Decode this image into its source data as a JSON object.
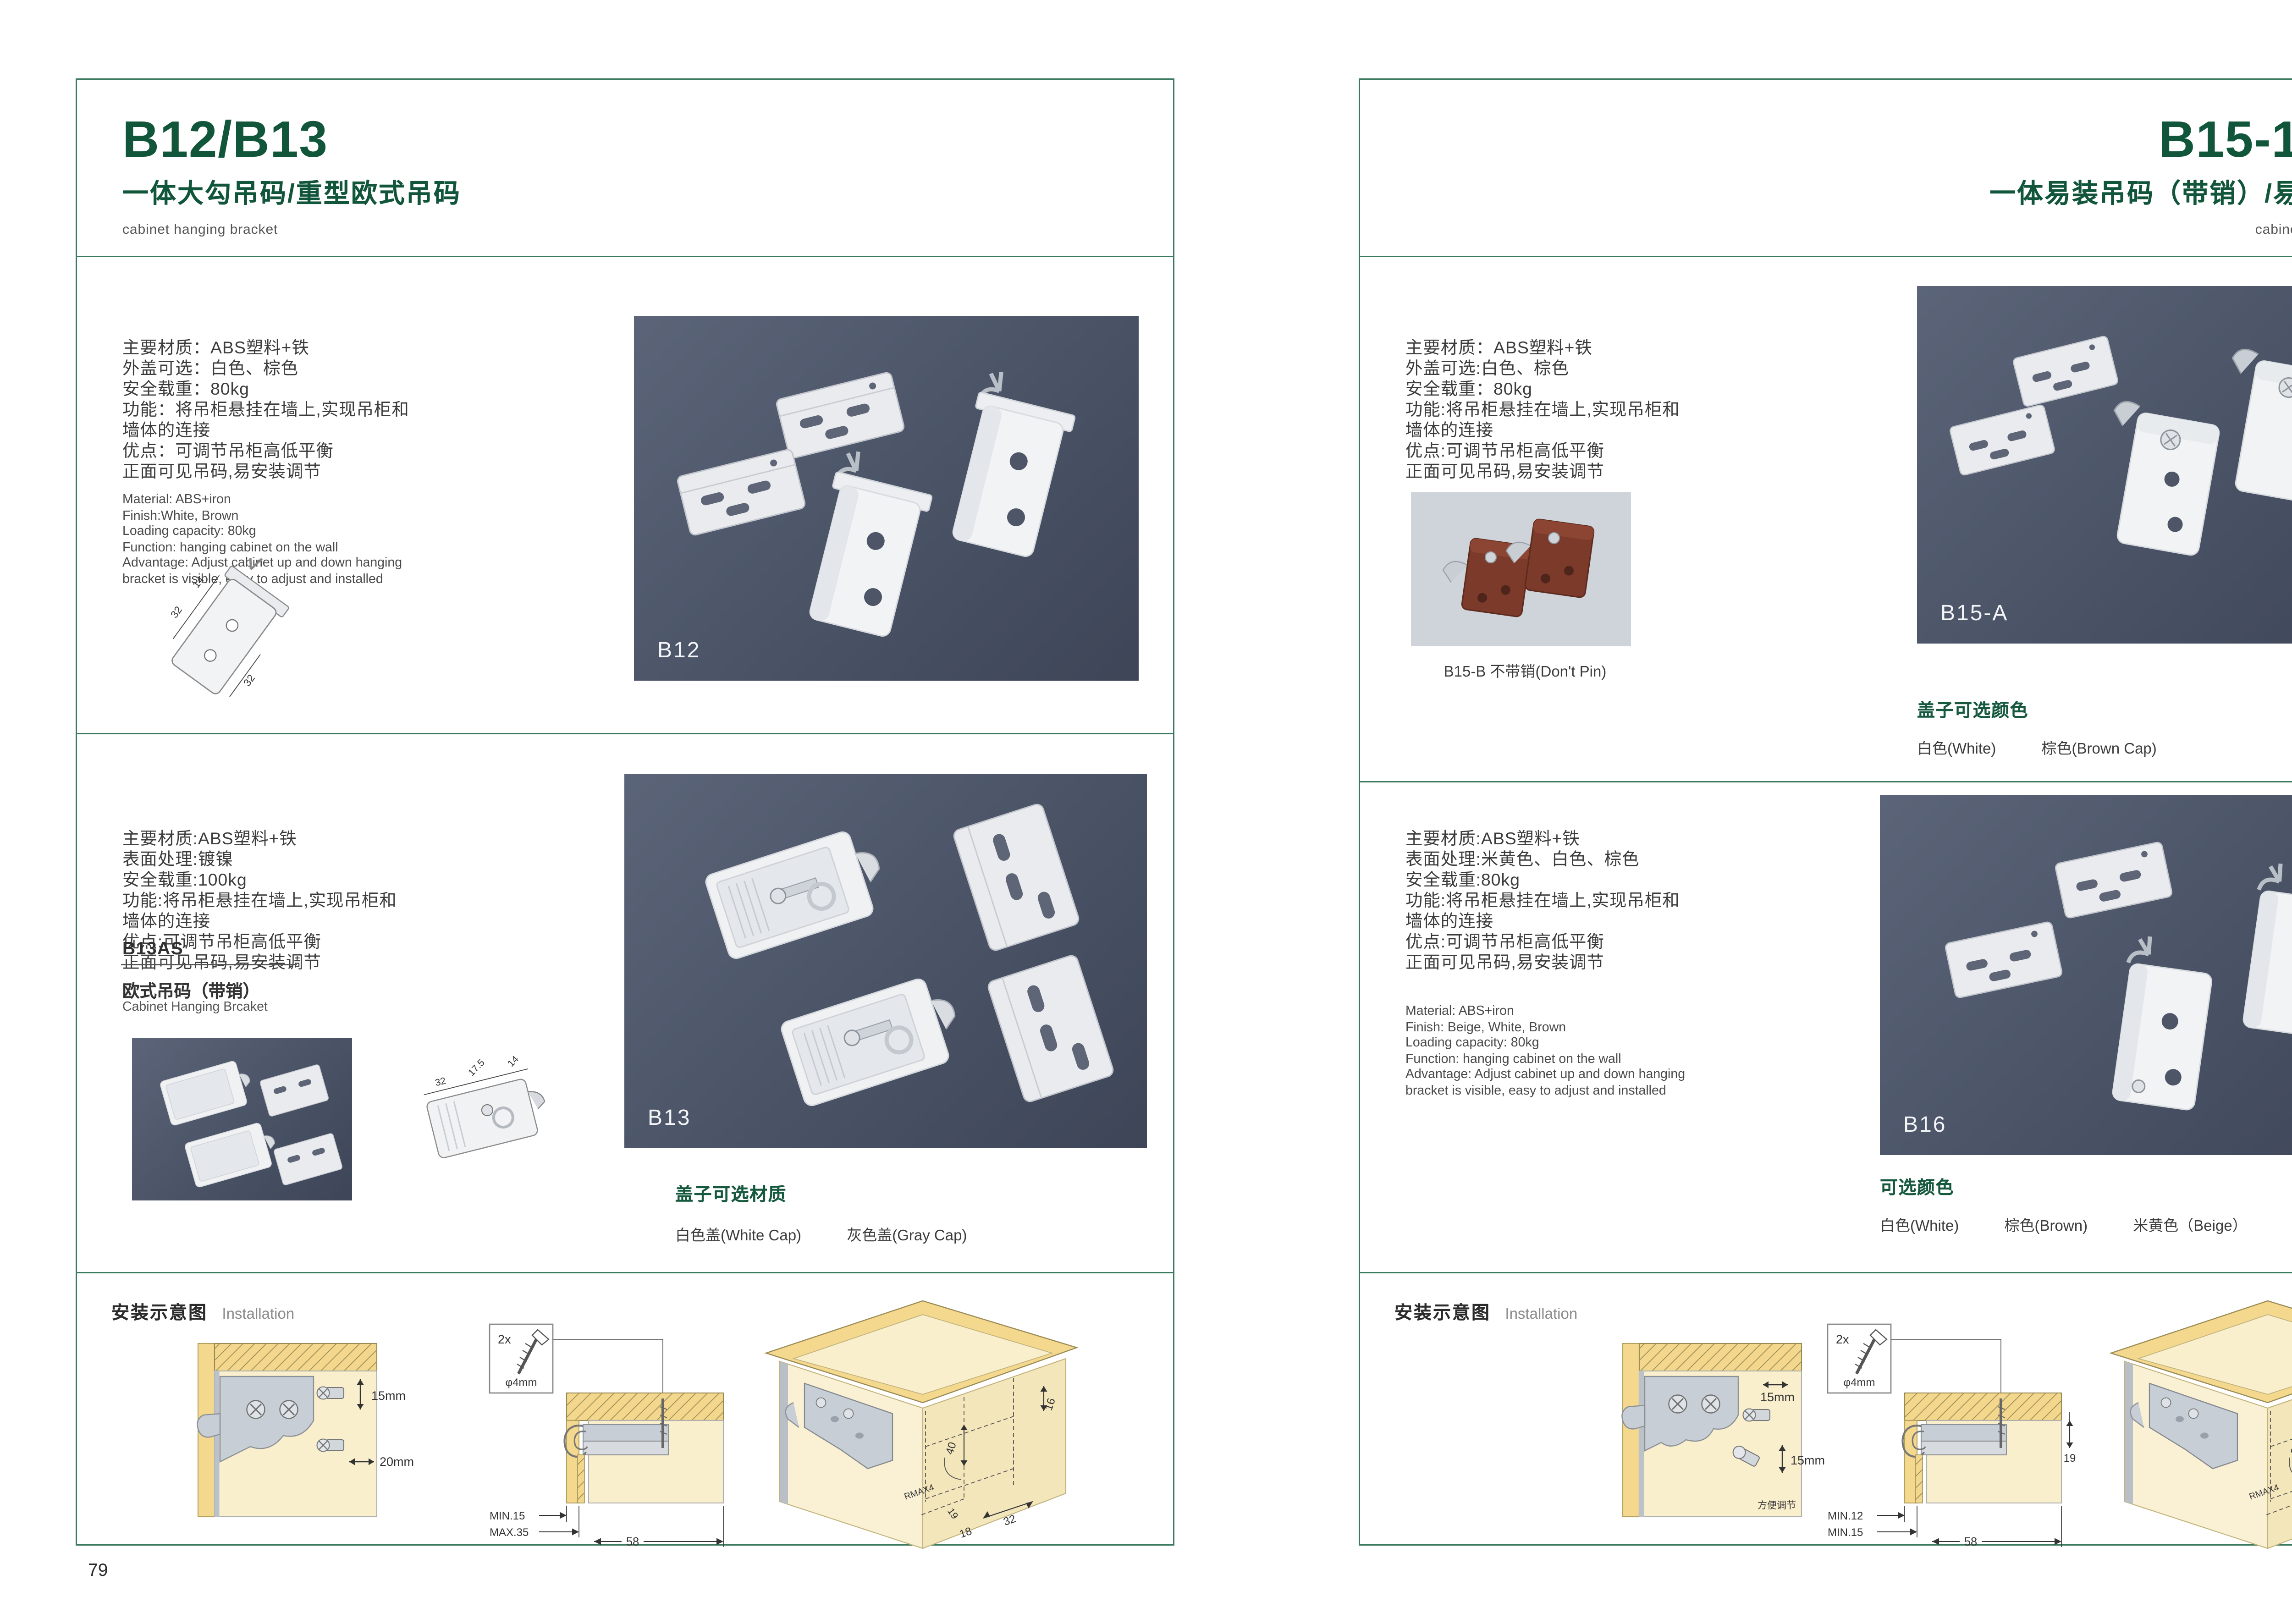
{
  "colors": {
    "accent_green": "#11563a",
    "border_green": "#3c7a60",
    "photo_background": "#4a5366",
    "wood_yellow": "#f3d88e",
    "wood_cream": "#f9efcd",
    "bracket_gray": "#c8ced5"
  },
  "left_page": {
    "page_number": "79",
    "header": {
      "title": "B12/B13",
      "subtitle": "一体大勾吊码/重型欧式吊码",
      "category": "cabinet hanging bracket"
    },
    "b12": {
      "specs_cn": [
        "主要材质：ABS塑料+铁",
        "外盖可选：白色、棕色",
        "安全载重：80kg",
        "功能：将吊柜悬挂在墙上,实现吊柜和",
        "墙体的连接",
        "优点：可调节吊柜高低平衡",
        "正面可见吊码,易安装调节"
      ],
      "specs_en": [
        "Material: ABS+iron",
        "Finish:White, Brown",
        "Loading capacity: 80kg",
        "Function: hanging cabinet on the wall",
        "Advantage: Adjust cabinet up and down hanging",
        "bracket is visible, easy to adjust and installed"
      ],
      "dims": {
        "a": "14",
        "b": "32",
        "c": "32"
      },
      "photo_label": "B12"
    },
    "b13": {
      "specs_cn": [
        "主要材质:ABS塑料+铁",
        "表面处理:镀镍",
        "安全载重:100kg",
        "功能:将吊柜悬挂在墙上,实现吊柜和",
        "墙体的连接",
        "优点:可调节吊柜高低平衡",
        "正面可见吊码,易安装调节"
      ],
      "model_code": "B13AS",
      "model_cn": "欧式吊码（带销）",
      "model_en": "Cabinet Hanging Brcaket",
      "dims": {
        "a": "32",
        "b": "17.5",
        "c": "14"
      },
      "photo_label": "B13",
      "options_title": "盖子可选材质",
      "options": [
        "白色盖(White Cap)",
        "灰色盖(Gray Cap)"
      ]
    },
    "install": {
      "title_cn": "安装示意图",
      "title_en": "Installation",
      "dim_v": "15mm",
      "dim_h": "20mm",
      "screw_qty": "2x",
      "screw_dia": "φ4mm",
      "min": "MIN.15",
      "max": "MAX.35",
      "span": "58",
      "d1": "16",
      "d2": "40",
      "d3": "RMAX4",
      "d4": "19",
      "d5": "18",
      "d6": "32"
    }
  },
  "right_page": {
    "page_number": "80",
    "header": {
      "title": "B15-1/B16",
      "subtitle": "一体易装吊码（带销）/易调节吊码",
      "category": "cabinet hanging bracket"
    },
    "b15": {
      "specs_cn": [
        "主要材质：ABS塑料+铁",
        "外盖可选:白色、棕色",
        "安全载重：80kg",
        "功能:将吊柜悬挂在墙上,实现吊柜和",
        "墙体的连接",
        "优点:可调节吊柜高低平衡",
        "正面可见吊码,易安装调节"
      ],
      "sub_caption": "B15-B 不带销(Don't Pin)",
      "photo_label": "B15-A",
      "options_title": "盖子可选颜色",
      "options": [
        "白色(White)",
        "棕色(Brown Cap)"
      ]
    },
    "b16": {
      "specs_cn": [
        "主要材质:ABS塑料+铁",
        "表面处理:米黄色、白色、棕色",
        "安全载重:80kg",
        "功能:将吊柜悬挂在墙上,实现吊柜和",
        "墙体的连接",
        "优点:可调节吊柜高低平衡",
        "正面可见吊码,易安装调节"
      ],
      "specs_en": [
        "Material: ABS+iron",
        "Finish: Beige, White, Brown",
        "Loading capacity: 80kg",
        "Function: hanging cabinet on the wall",
        "Advantage: Adjust cabinet up and down hanging",
        "bracket is visible, easy to adjust and installed"
      ],
      "photo_label": "B16",
      "options_title": "可选颜色",
      "options": [
        "白色(White)",
        "棕色(Brown)",
        "米黄色（Beige）"
      ]
    },
    "install": {
      "title_cn": "安装示意图",
      "title_en": "Installation",
      "dim_t": "15mm",
      "dim_v": "15mm",
      "note": "方便调节",
      "screw_qty": "2x",
      "screw_dia": "φ4mm",
      "min1": "MIN.12",
      "min2": "MIN.15",
      "span": "58",
      "side": "19",
      "d1": "30",
      "d2": "32",
      "d3": "RMAX4",
      "d4": "19",
      "d5": "20",
      "d6": "32"
    }
  }
}
